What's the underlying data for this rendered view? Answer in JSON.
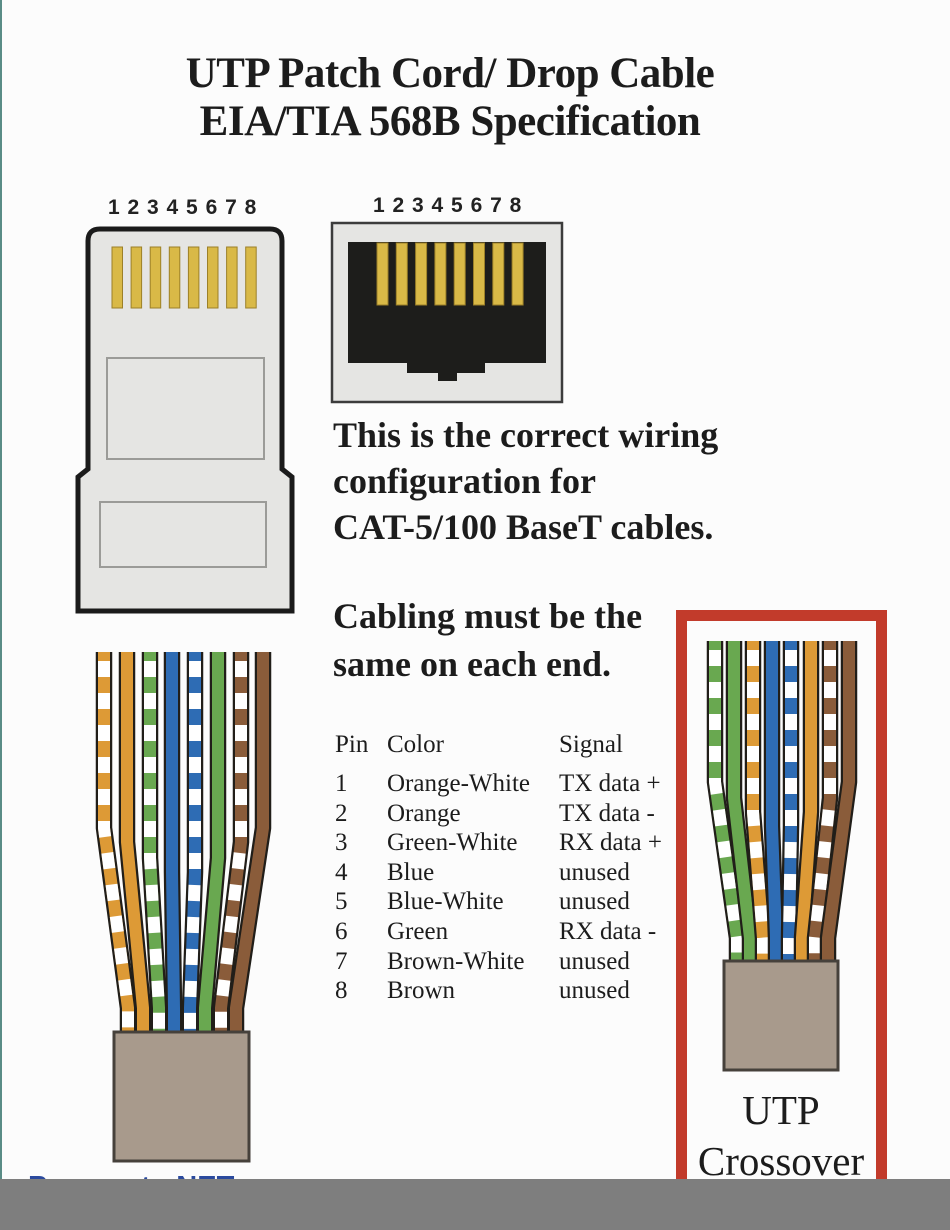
{
  "title": {
    "line1": "UTP Patch Cord/ Drop Cable",
    "line2": "EIA/TIA 568B Specification"
  },
  "plug": {
    "pin_numbers": "1 2 3 4 5 6 7 8"
  },
  "jack": {
    "pin_numbers": "1 2 3 4 5 6 7 8"
  },
  "paragraphs": {
    "wiring": [
      "This is the correct wiring",
      "configuration for",
      "CAT-5/100 BaseT cables."
    ],
    "cabling": [
      "Cabling must be the",
      "same on each end."
    ]
  },
  "table": {
    "headers": [
      "Pin",
      "Color",
      "Signal"
    ],
    "rows": [
      [
        "1",
        "Orange-White",
        "TX data +"
      ],
      [
        "2",
        "Orange",
        "TX data -"
      ],
      [
        "3",
        "Green-White",
        "RX data +"
      ],
      [
        "4",
        "Blue",
        "unused"
      ],
      [
        "5",
        "Blue-White",
        "unused"
      ],
      [
        "6",
        "Green",
        "RX data -"
      ],
      [
        "7",
        "Brown-White",
        "unused"
      ],
      [
        "8",
        "Brown",
        "unused"
      ]
    ]
  },
  "crossover_box": {
    "label_line1": "UTP",
    "label_line2": "Crossover"
  },
  "watermark": "Pressauto.NET",
  "cables": {
    "straight_order": [
      "orange-white",
      "orange",
      "green-white",
      "blue",
      "blue-white",
      "green",
      "brown-white",
      "brown"
    ],
    "crossover_order": [
      "green-white",
      "green",
      "orange-white",
      "blue",
      "blue-white",
      "orange",
      "brown-white",
      "brown"
    ]
  },
  "colors": {
    "orange": "#DD9A36",
    "green": "#69A850",
    "blue": "#2E6CB4",
    "brown": "#8A5C3A",
    "gold": "#D9B947",
    "sheath": "#A89A8C",
    "redFrame": "#C23B2B",
    "wireOutline": "#211E19",
    "connectorBody": "#E5E5E3",
    "jackInner": "#1D1D1B",
    "watermarkBlue": "#2B4A9E",
    "bottomBar": "#7E7E7E",
    "pageBg": "#FCFCFC",
    "edgeTeal": "#5A8C86",
    "text": "#1C1C1C"
  }
}
